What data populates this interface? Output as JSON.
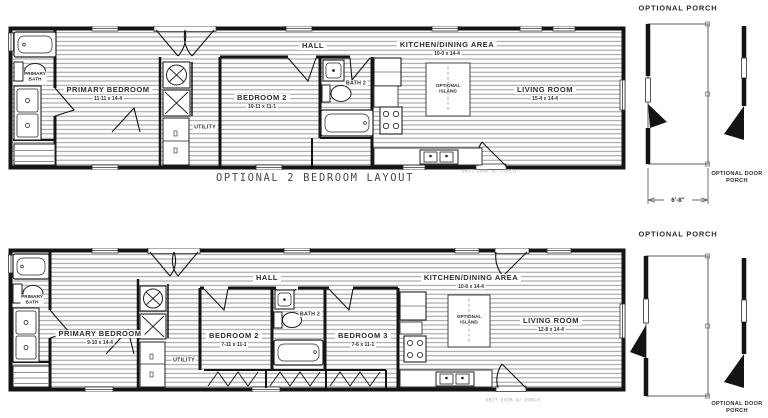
{
  "plan_top": {
    "caption": "OPTIONAL 2 BEDROOM LAYOUT",
    "hall_label": "HALL",
    "kitchen_label": "KITCHEN/DINING AREA",
    "kitchen_dims": "10-0 x 14-4",
    "primary_bath_label": "PRIMARY BATH",
    "primary_bedroom_label": "PRIMARY BEDROOM",
    "primary_bedroom_dims": "11-11 x 14-4",
    "utility_label": "UTILITY",
    "bedroom2_label": "BEDROOM 2",
    "bedroom2_dims": "10-11 x 11-1",
    "bath2_label": "BATH 2",
    "island_label": "OPTIONAL ISLAND",
    "living_room_label": "LIVING ROOM",
    "living_room_dims": "15-4 x 14-4",
    "unit_note": "OMIT DOOR W/ PORCH"
  },
  "plan_bottom": {
    "hall_label": "HALL",
    "kitchen_label": "KITCHEN/DINING AREA",
    "kitchen_dims": "10-0 x 14-4",
    "primary_bath_label": "PRIMARY BATH",
    "primary_bedroom_label": "PRIMARY BEDROOM",
    "primary_bedroom_dims": "9-10 x 14-4",
    "utility_label": "UTILITY",
    "bedroom2_label": "BEDROOM 2",
    "bedroom2_dims": "7-11 x 11-1",
    "bedroom3_label": "BEDROOM 3",
    "bedroom3_dims": "7-6 x 11-1",
    "bath2_label": "BATH 2",
    "island_label": "OPTIONAL ISLAND",
    "living_room_label": "LIVING ROOM",
    "living_room_dims": "12-8 x 14-4",
    "unit_note": "OMIT DOOR W/ PORCH"
  },
  "options_panel": {
    "porch_top_title": "OPTIONAL PORCH",
    "porch_top_width": "6'-8\"",
    "door_porch_top_label": "OPTIONAL DOOR PORCH",
    "porch_bottom_title": "OPTIONAL PORCH",
    "door_porch_bottom_label": "OPTIONAL DOOR PORCH"
  },
  "colors": {
    "wall": "#141414",
    "hatch": "#8f8f8f",
    "label": "#2d2d2d",
    "note": "#a9a9a9",
    "background": "#ffffff"
  }
}
